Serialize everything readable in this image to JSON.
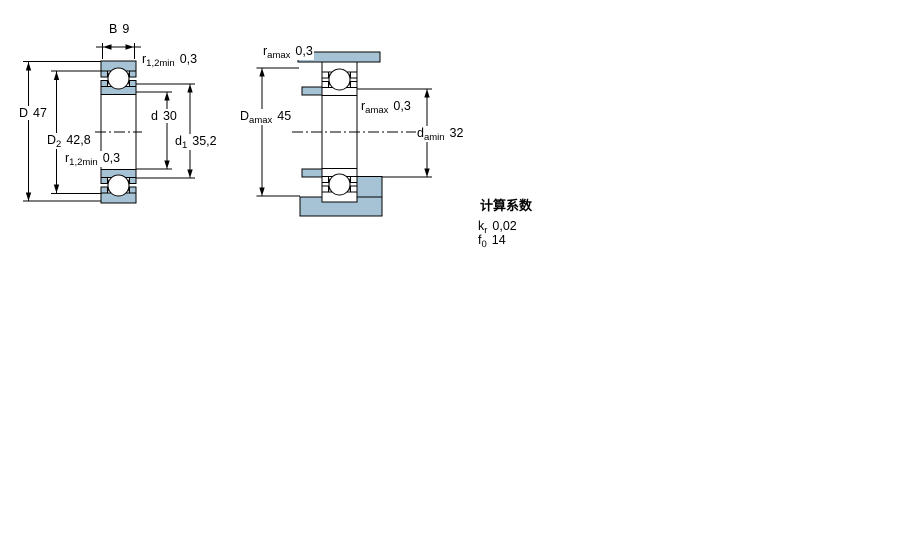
{
  "figure_type": "bearing-dimension-drawing",
  "colors": {
    "section_fill": "#a6c3d6",
    "line": "#000000",
    "background": "#ffffff"
  },
  "left": {
    "name": "bearing-cross-section-dimensions",
    "labels": {
      "b": {
        "base": "B",
        "sub": "",
        "value": "9"
      },
      "r_top": {
        "base": "r",
        "sub": "1,2min",
        "value": "0,3"
      },
      "D": {
        "base": "D",
        "sub": "",
        "value": "47"
      },
      "D2": {
        "base": "D",
        "sub": "2",
        "value": "42,8"
      },
      "r_bot": {
        "base": "r",
        "sub": "1,2min",
        "value": "0,3"
      },
      "d": {
        "base": "d",
        "sub": "",
        "value": "30"
      },
      "d1": {
        "base": "d",
        "sub": "1",
        "value": "35,2"
      }
    }
  },
  "right": {
    "name": "bearing-abutment-dimensions",
    "labels": {
      "ra_top": {
        "base": "r",
        "sub": "amax",
        "value": "0,3"
      },
      "Da": {
        "base": "D",
        "sub": "amax",
        "value": "45"
      },
      "ra_mid": {
        "base": "r",
        "sub": "amax",
        "value": "0,3"
      },
      "da": {
        "base": "d",
        "sub": "amin",
        "value": "32"
      }
    }
  },
  "calculation_factors": {
    "title": "计算系数",
    "rows": [
      {
        "base": "k",
        "sub": "r",
        "value": "0,02"
      },
      {
        "base": "f",
        "sub": "0",
        "value": "14"
      }
    ]
  }
}
